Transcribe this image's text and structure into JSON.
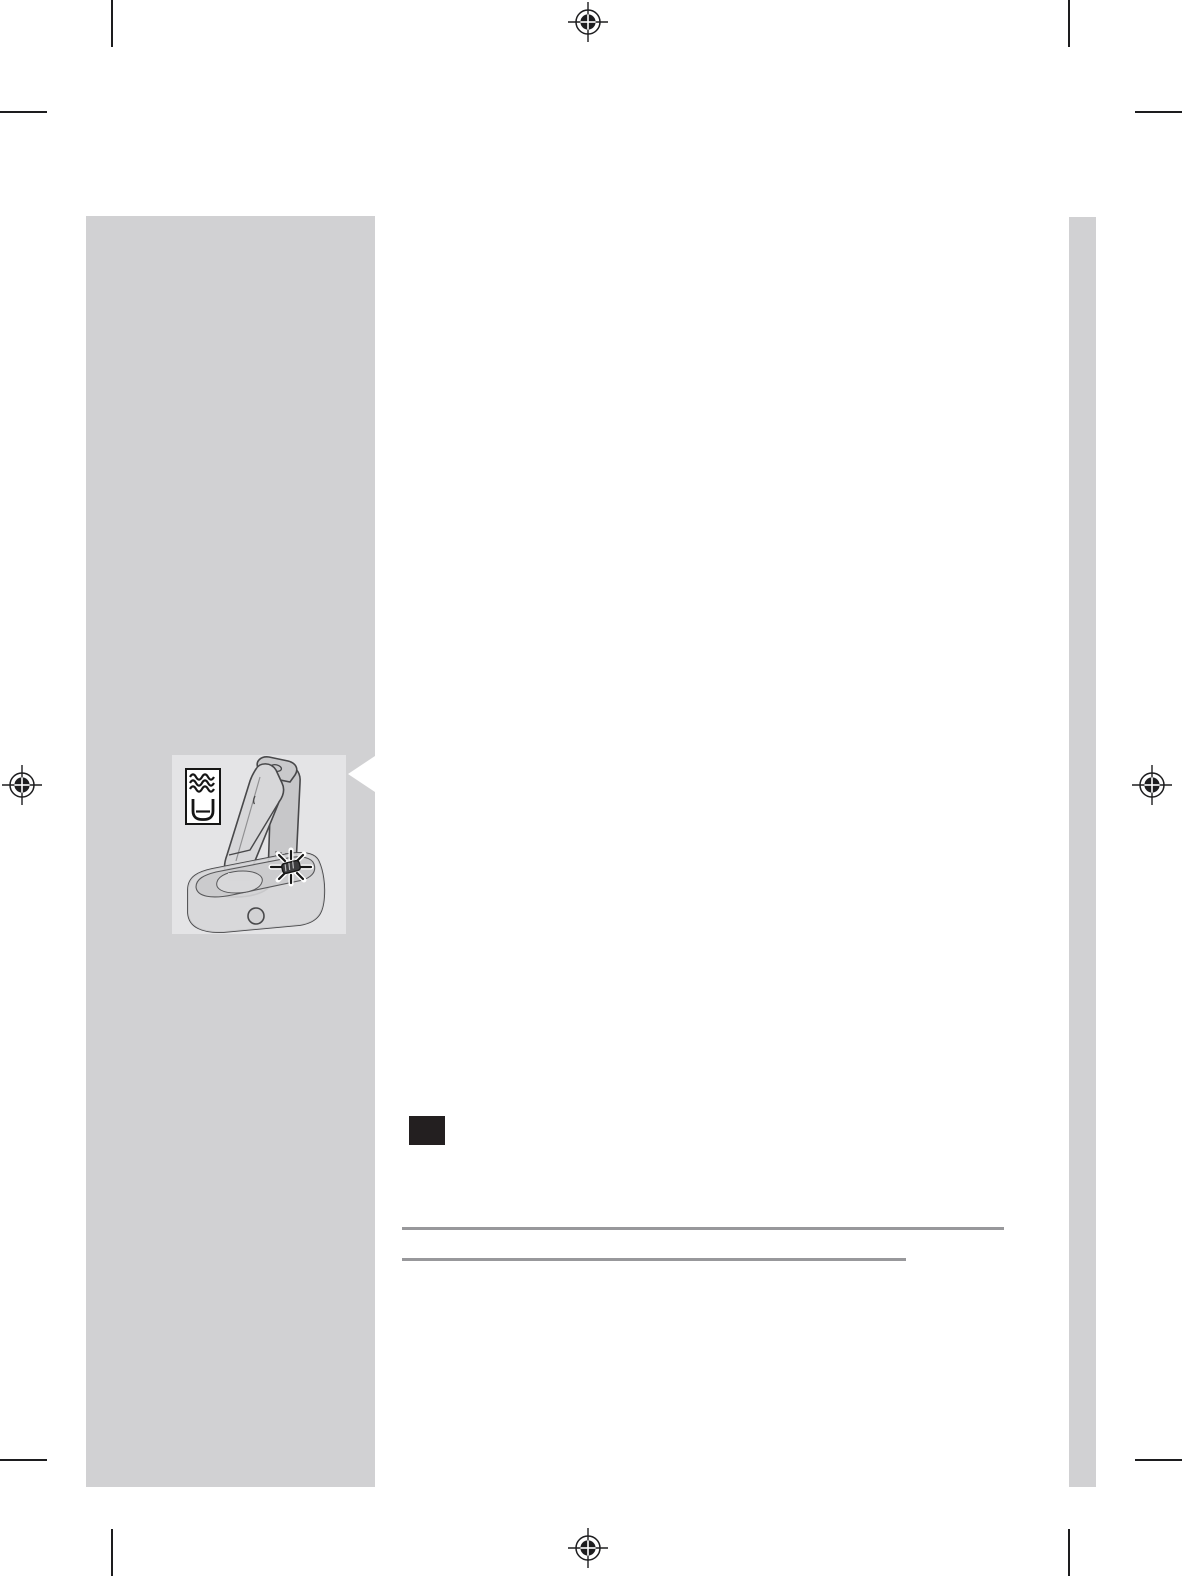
{
  "document": {
    "kind": "print-prepress page (user manual spread), mostly blank with printer marks",
    "background_color": "#ffffff",
    "visible_text": ""
  },
  "colors": {
    "sidebar_gray": "#d1d1d3",
    "callout_box_gray": "#e4e4e6",
    "rule_gray": "#98989b",
    "print_mark_black": "#1d1d1f",
    "section_marker_black": "#231f20",
    "line_art_stroke": "#48484a"
  },
  "print_marks": {
    "registration_marks": [
      {
        "name": "registration-mark-top-center"
      },
      {
        "name": "registration-mark-left-middle"
      },
      {
        "name": "registration-mark-right-middle"
      },
      {
        "name": "registration-mark-bottom-center"
      }
    ],
    "crop_mark_corners": [
      "top-left",
      "top-right",
      "bottom-left",
      "bottom-right"
    ]
  },
  "sidebar": {
    "illustration": {
      "description": "shaver docked in clean-and-charge station with blinking indicator light",
      "icons": [
        {
          "name": "water-waves-icon",
          "meaning": "rinse / cleaning fluid"
        },
        {
          "name": "cleaning-fluid-cup-icon",
          "meaning": "container with fluid level"
        },
        {
          "name": "blinking-indicator-icon",
          "meaning": "flashing LED on station"
        }
      ],
      "callout_pointer": "white notch pointing left from text column toward illustration"
    }
  },
  "content": {
    "section_marker": "solid black square",
    "rules": [
      {
        "name": "long-rule"
      },
      {
        "name": "short-rule"
      }
    ]
  }
}
